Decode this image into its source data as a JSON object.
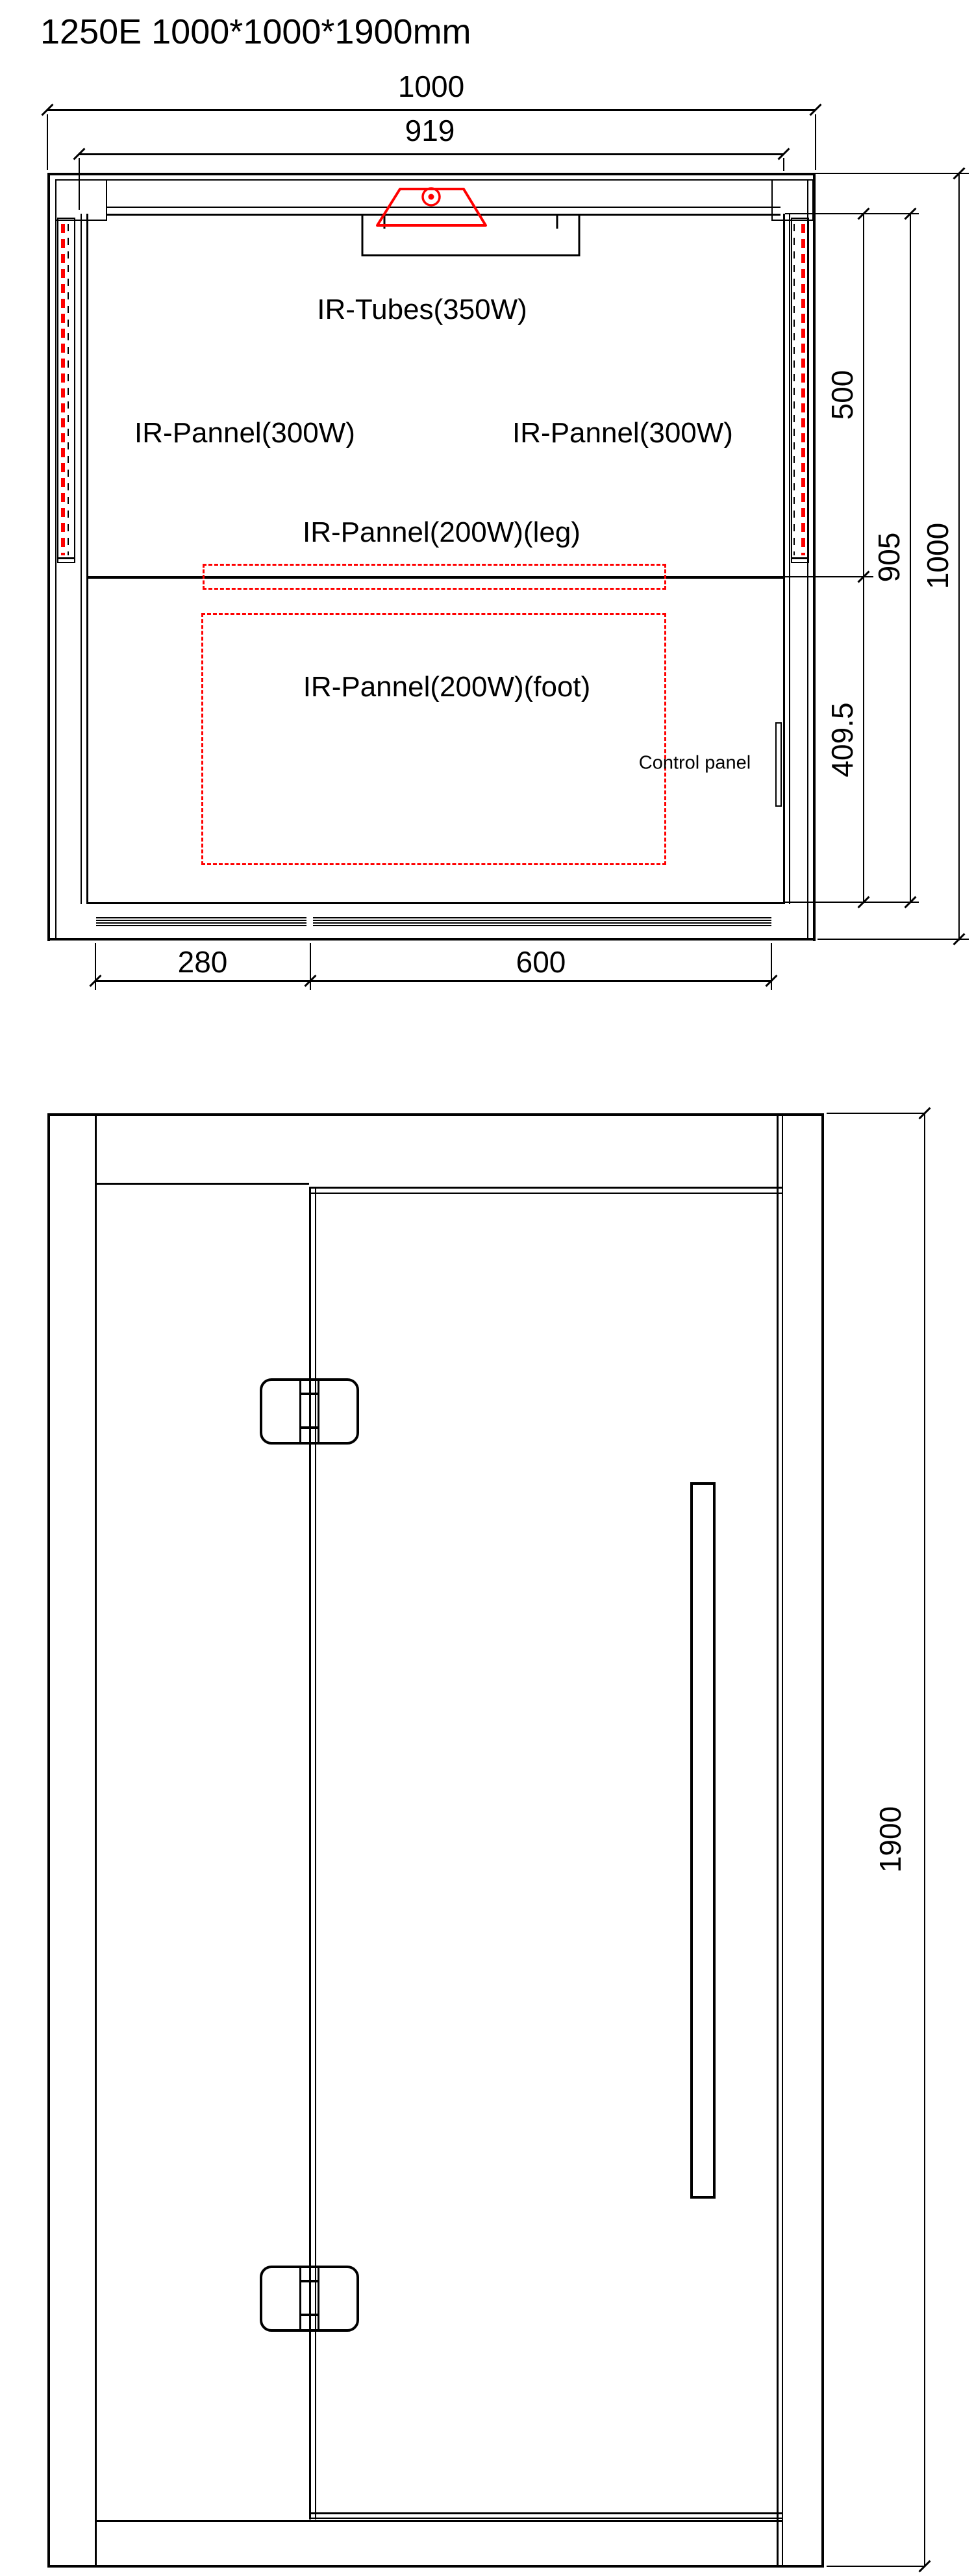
{
  "title": "1250E 1000*1000*1900mm",
  "colors": {
    "line": "#000000",
    "ir_element": "#ff0000"
  },
  "plan_view": {
    "labels": {
      "ir_tubes": "IR-Tubes(350W)",
      "ir_panel_left": "IR-Pannel(300W)",
      "ir_panel_right": "IR-Pannel(300W)",
      "ir_panel_leg": "IR-Pannel(200W)(leg)",
      "ir_panel_foot": "IR-Pannel(200W)(foot)",
      "control_panel": "Control panel"
    },
    "dimensions": {
      "top_width": "1000",
      "glass_width": "919",
      "bench_depth": "500",
      "interior_depth": "905",
      "side_depth": "1000",
      "foot_zone_depth": "409.5",
      "front_left_width": "280",
      "front_door_width": "600"
    }
  },
  "elevation_view": {
    "dimensions": {
      "overall_height": "1900"
    }
  }
}
